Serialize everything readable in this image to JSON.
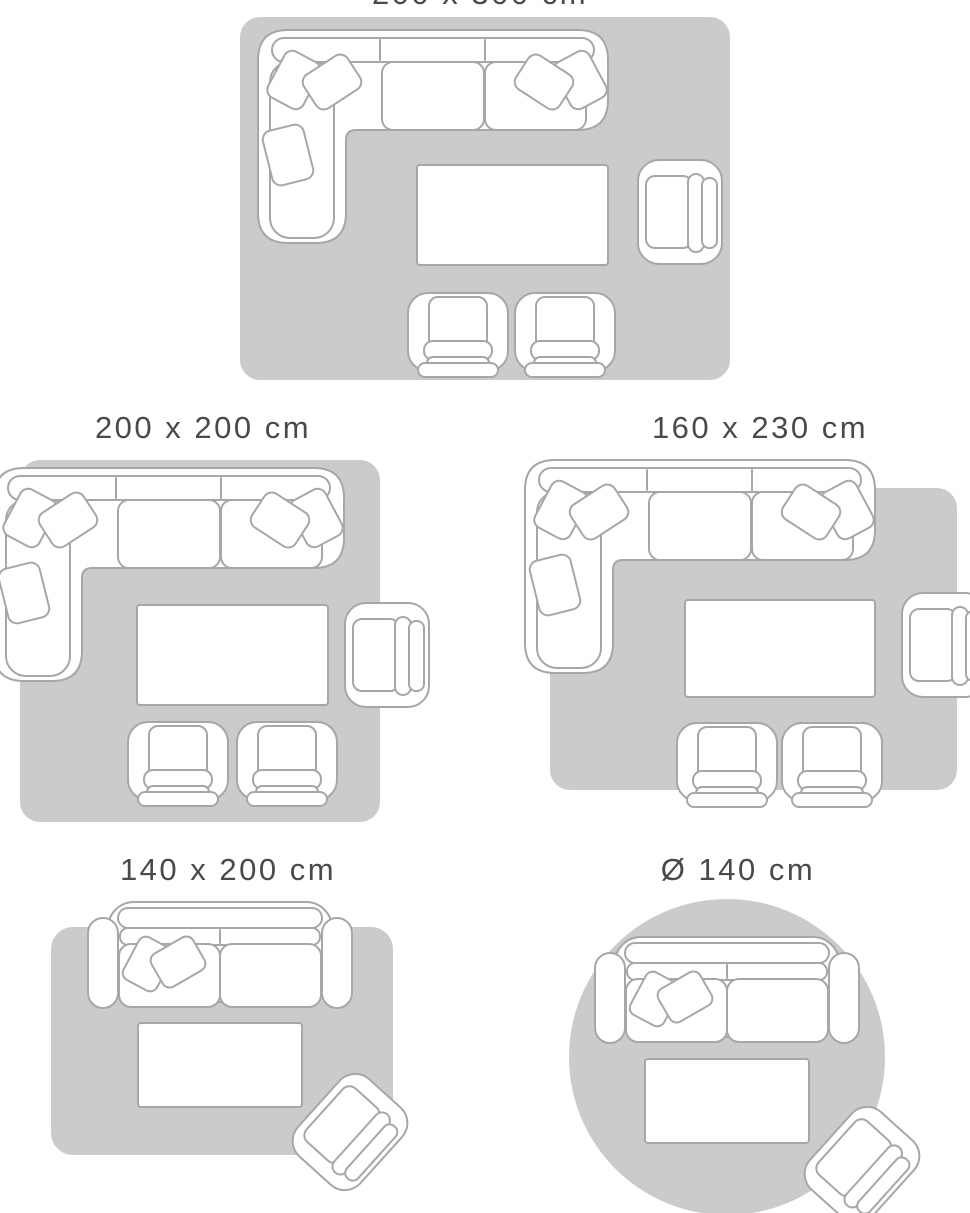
{
  "colors": {
    "background": "#ffffff",
    "rug": "#cbcbcb",
    "furniture_outline": "#a7a7a7",
    "furniture_fill": "#ffffff",
    "title_text": "#4a4a4a"
  },
  "scenes": [
    {
      "title": "200 x 300 cm",
      "rug_shape": "rectangle",
      "furniture": [
        "corner-sofa-with-pillows",
        "coffee-table",
        "armchair",
        "lounge-chair",
        "lounge-chair"
      ]
    },
    {
      "title": "200 x 200 cm",
      "rug_shape": "square",
      "furniture": [
        "corner-sofa-with-pillows",
        "coffee-table",
        "armchair",
        "lounge-chair",
        "lounge-chair"
      ]
    },
    {
      "title": "160 x 230 cm",
      "rug_shape": "rectangle",
      "furniture": [
        "corner-sofa-with-pillows",
        "coffee-table",
        "armchair",
        "lounge-chair",
        "lounge-chair"
      ]
    },
    {
      "title": "140 x 200 cm",
      "rug_shape": "rectangle",
      "furniture": [
        "two-seat-sofa-with-pillows",
        "coffee-table",
        "armchair"
      ]
    },
    {
      "title": "Ø 140 cm",
      "rug_shape": "circle",
      "furniture": [
        "two-seat-sofa-with-pillows",
        "coffee-table",
        "armchair"
      ]
    }
  ]
}
